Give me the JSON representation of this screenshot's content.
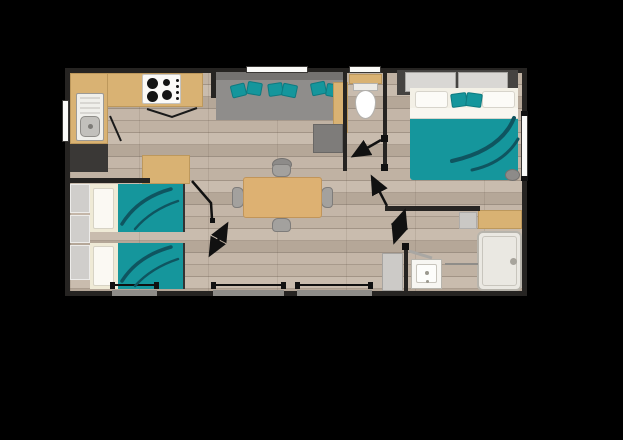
{
  "image_type": "floor-plan",
  "description": "Top-down 2D floor plan of a two-bedroom mobile home on a black background",
  "colors": {
    "background": "#000000",
    "wall": "#262422",
    "floor_wood_light": "#c9bcae",
    "floor_wood_dark": "#a29486",
    "furniture_wood": "#d9b273",
    "accent_teal": "#15969c",
    "accent_teal_dark": "#0f5560",
    "sofa_gray": "#8f8d8b",
    "linen_white": "#f5f3ee"
  },
  "rooms": [
    {
      "id": "kitchen",
      "name": "kitchen",
      "position": "top-left"
    },
    {
      "id": "living-room",
      "name": "living room",
      "position": "top-center"
    },
    {
      "id": "dining-area",
      "name": "dining area",
      "position": "center"
    },
    {
      "id": "wc",
      "name": "separate WC",
      "position": "top-center-right"
    },
    {
      "id": "master-bedroom",
      "name": "master bedroom",
      "position": "right"
    },
    {
      "id": "twin-bedroom",
      "name": "twin bedroom",
      "position": "bottom-left"
    },
    {
      "id": "bathroom",
      "name": "shower room",
      "position": "bottom-right"
    },
    {
      "id": "hallway",
      "name": "hallway",
      "position": "center-right"
    }
  ],
  "furniture": {
    "kitchen": [
      "worktop",
      "sink with drainer",
      "hob with 4 burners",
      "fridge",
      "island unit"
    ],
    "living_room": [
      "corner sofa",
      "6 teal cushions",
      "side unit",
      "square pouf",
      "small pouf"
    ],
    "dining_area": [
      "rectangular table",
      "4 chairs"
    ],
    "wc": [
      "toilet",
      "shelf"
    ],
    "master_bedroom": [
      "sliding-door wardrobe",
      "double bed",
      "2 white pillows",
      "2 teal cushions",
      "stool",
      "dresser"
    ],
    "twin_bedroom": [
      "single bed x2",
      "wall shelving x3"
    ],
    "bathroom": [
      "shower tray",
      "washbasin",
      "towel rail",
      "storage cabinet",
      "vanity top"
    ]
  },
  "openings": {
    "windows_top": 2,
    "window_left": 1,
    "window_right": 1,
    "bays_bottom": 3,
    "interior_doors": 4,
    "entrance_door": 1
  }
}
